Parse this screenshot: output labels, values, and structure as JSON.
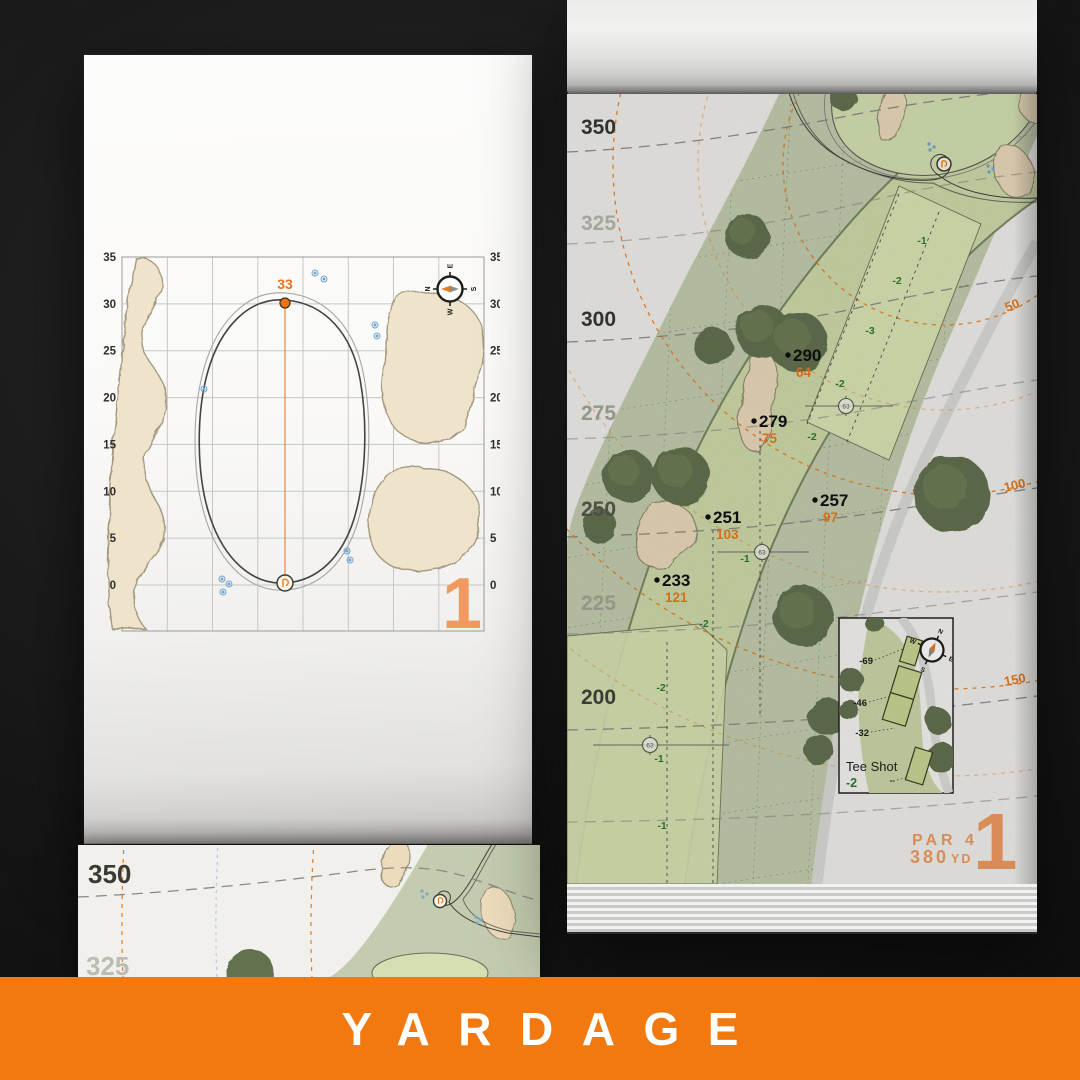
{
  "banner": {
    "label": "YARDAGE"
  },
  "colors": {
    "banner_orange": "#f2790f",
    "accent_orange": "#e87b1f",
    "muted_orange": "#ee9b62",
    "elevation_green": "#2f7a33",
    "sprinkler_blue": "#7ba7c9"
  },
  "compass": {
    "n": "N",
    "e": "E",
    "s": "S",
    "w": "W"
  },
  "left_page": {
    "hole_number": "1",
    "pin_label": "33",
    "axis_ticks": [
      "35",
      "30",
      "25",
      "20",
      "15",
      "10",
      "5",
      "0"
    ]
  },
  "right_page": {
    "hole_number": "1",
    "par_label": "PAR 4",
    "yardage_value": "380",
    "yardage_unit": "YD",
    "distance_labels": [
      "350",
      "325",
      "300",
      "275",
      "250",
      "225",
      "200"
    ],
    "arc_labels": [
      "50",
      "100",
      "150"
    ],
    "points": [
      {
        "carry": "290",
        "remaining": "64"
      },
      {
        "carry": "279",
        "remaining": "75"
      },
      {
        "carry": "257",
        "remaining": "97"
      },
      {
        "carry": "251",
        "remaining": "103"
      },
      {
        "carry": "233",
        "remaining": "121"
      }
    ],
    "elevation_labels": [
      "-1",
      "-2",
      "-3",
      "-2",
      "-2",
      "-1",
      "-2",
      "-2",
      "-1",
      "-1"
    ],
    "sprinkler_label": "63",
    "tee_box": {
      "title": "Tee Shot",
      "elevation": "-2",
      "tee_offsets": [
        "-69",
        "-46",
        "-32",
        "--"
      ]
    }
  },
  "bottom_page": {
    "distance_labels": [
      "350",
      "325"
    ]
  }
}
